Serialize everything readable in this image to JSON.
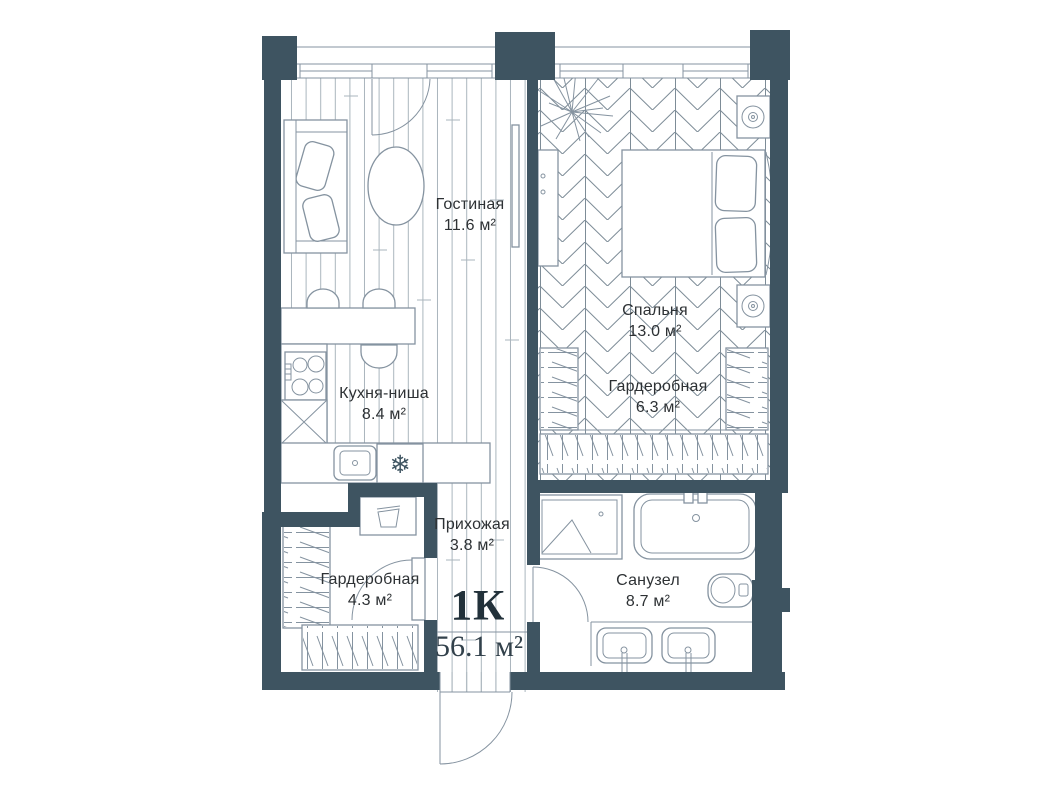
{
  "plan": {
    "apartment_type": "1К",
    "total_area": "56.1 м²",
    "rooms": [
      {
        "name": "Гостиная",
        "area": "11.6 м²"
      },
      {
        "name": "Спальня",
        "area": "13.0 м²"
      },
      {
        "name": "Гардеробная",
        "area": "6.3 м²"
      },
      {
        "name": "Кухня-ниша",
        "area": "8.4 м²"
      },
      {
        "name": "Прихожая",
        "area": "3.8 м²"
      },
      {
        "name": "Гардеробная",
        "area": "4.3 м²"
      },
      {
        "name": "Санузел",
        "area": "8.7 м²"
      }
    ],
    "icons": {
      "fridge": "❄"
    },
    "colors": {
      "wall": "#3e5461",
      "line": "#8593a0",
      "plank": "#aab5bd",
      "herring": "#7d8c97",
      "text": "#2d3134"
    }
  }
}
